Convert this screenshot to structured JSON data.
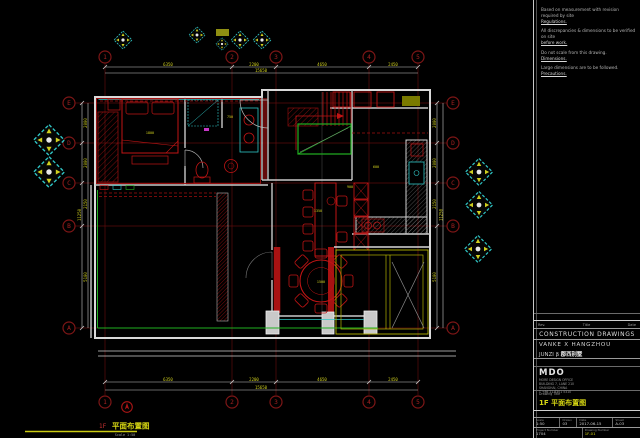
{
  "title_block": {
    "notes": [
      {
        "l1": "Based on measurement with revision required by site",
        "l2": "Regulations."
      },
      {
        "l1": "All discrepancies & dimensions to be verified on site",
        "l2": "before work."
      },
      {
        "l1": "Do not scale from this drawing.",
        "l2": "Dimensions."
      },
      {
        "l1": "Large dimensions are to be followed.",
        "l2": "Precautions."
      }
    ],
    "header_fields": [
      "Rev.",
      "Title",
      "Date"
    ],
    "doc_type": "CONSTRUCTION DRAWINGS",
    "project_name": "VANKE X HANGZHOU",
    "project_sub": "JUNZI β",
    "project_sub_cn": "郡西别墅",
    "company": "MDO",
    "company_lines": [
      "MORE DESIGN OFFICE",
      "BUILDING 7, LANE 210",
      "SHANGHAI, CHINA",
      "T +86 21 6301 5310"
    ],
    "drawing_title_label": "Drawing Title",
    "drawing_title": "1F 平面布置图",
    "fields": {
      "row1_labels": [
        "Scale",
        "Drawn",
        "Date",
        "Sheet"
      ],
      "row1_values": [
        "1:50",
        "03",
        "2017-06-15",
        "A-03"
      ],
      "row2_labels": [
        "Project Number",
        "Drawing Number"
      ],
      "row2_values": [
        "1704",
        "1F-01"
      ]
    }
  },
  "footer": {
    "floor_prefix": "1F",
    "title_cn": "平面布置图",
    "scale": "Scale 1:50"
  },
  "grid": {
    "cols": [
      "1",
      "2",
      "3",
      "4",
      "5"
    ],
    "rows": [
      "E",
      "D",
      "C",
      "B",
      "A"
    ]
  },
  "dims": {
    "top": [
      "6350",
      "2200",
      "4650",
      "2450"
    ],
    "top_overall": "15650",
    "bottom": [
      "6350",
      "2200",
      "4650",
      "2450"
    ],
    "bottom_overall": "15650",
    "left": [
      "2000",
      "2000",
      "2150",
      "5100"
    ],
    "left_overall": "11250",
    "right": [
      "2000",
      "2000",
      "2150",
      "5100"
    ],
    "right_overall": "11250"
  },
  "plan_dims": {
    "bed": "1800",
    "bath": "750",
    "kitchen": "600",
    "cabinet": "900",
    "island": "1350",
    "round_table": "1500"
  },
  "colors": {
    "background": "#000000",
    "wall": "#d9d9d9",
    "furniture_red": "#c01414",
    "grid_red": "#5c0d0d",
    "bubble_red": "#a32121",
    "cyan": "#2fc6c6",
    "green": "#21b021",
    "olive": "#b3b300",
    "dim_yellow": "#cfcf1e",
    "title_yellow": "#d8d813"
  }
}
